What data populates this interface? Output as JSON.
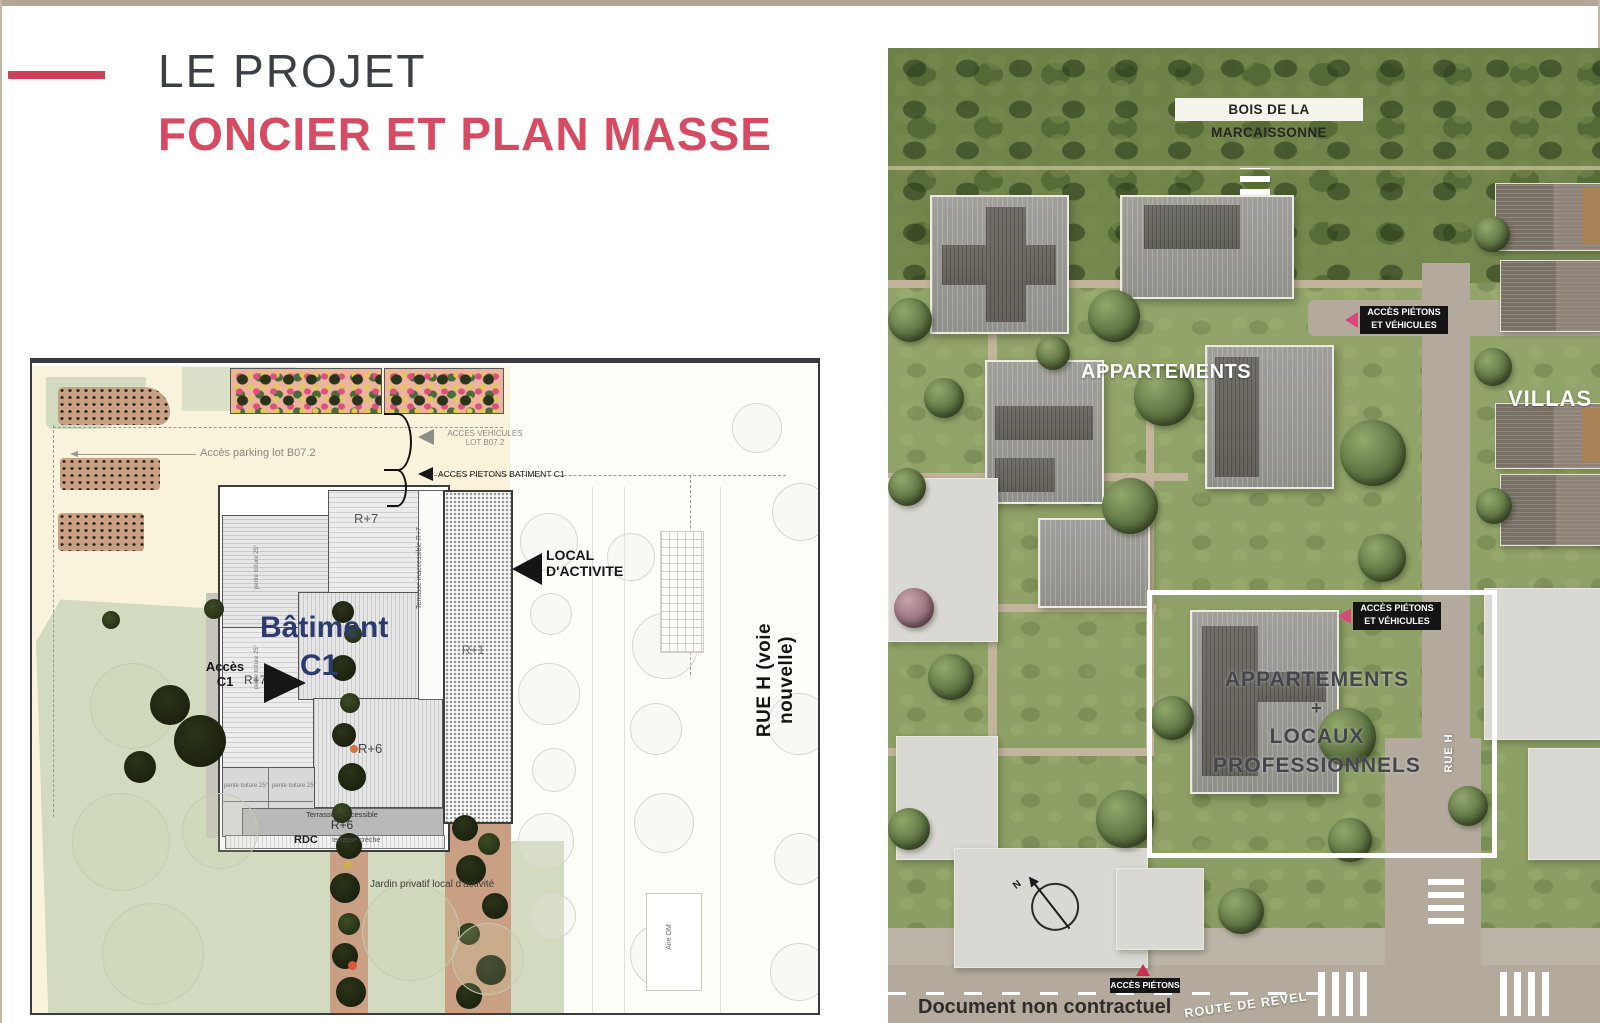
{
  "slide": {
    "title_line1": "LE PROJET",
    "title_line2": "FONCIER ET PLAN MASSE"
  },
  "colors": {
    "accent_red": "#d64a62",
    "title_gray": "#3e3e45",
    "navy_building": "#2c3a6e",
    "plan_cream": "#faf3dc",
    "plan_sage": "#d2dabf",
    "pink_triangle": "#d8497b",
    "label_black": "#141414"
  },
  "site_plan": {
    "acces_parking": "Accès parking lot B07.2",
    "acces_vehicules_1": "ACCES VEHICULES",
    "acces_vehicules_2": "LOT B07.2",
    "acces_pietons": "ACCES PIETONS BATIMENT C1",
    "batiment_1": "Bâtiment",
    "batiment_2": "C1",
    "r7": "R+7",
    "r7c": "R+7+C",
    "r6": "R+6",
    "r1": "R+1",
    "rdc": "RDC",
    "terrasse": "Terrasse inaccessible",
    "terrasse_creche": "terrasse crèche",
    "pente": "pente toiture 25°",
    "acces_c1_1": "Accès",
    "acces_c1_2": "C1",
    "local_1": "LOCAL",
    "local_2": "D'ACTIVITE",
    "jardin": "Jardin privatif local d'activité",
    "rue_h": "RUE H (voie nouvelle)",
    "aire_om": "Aire OM"
  },
  "aerial": {
    "bois": "BOIS DE LA MARCAISSONNE",
    "appartements": "APPARTEMENTS",
    "villas": "VILLAS",
    "acces_pv_1": "ACCÈS PIÉTONS",
    "acces_pv_2": "ET VÉHICULES",
    "hl_1": "APPARTEMENTS",
    "hl_2": "+",
    "hl_3": "LOCAUX",
    "hl_4": "PROFESSIONNELS",
    "rue_h": "RUE H",
    "acces_pietons": "ACCÈS PIÉTONS",
    "route": "ROUTE DE REVEL",
    "document": "Document non contractuel",
    "compass_n": "N"
  }
}
